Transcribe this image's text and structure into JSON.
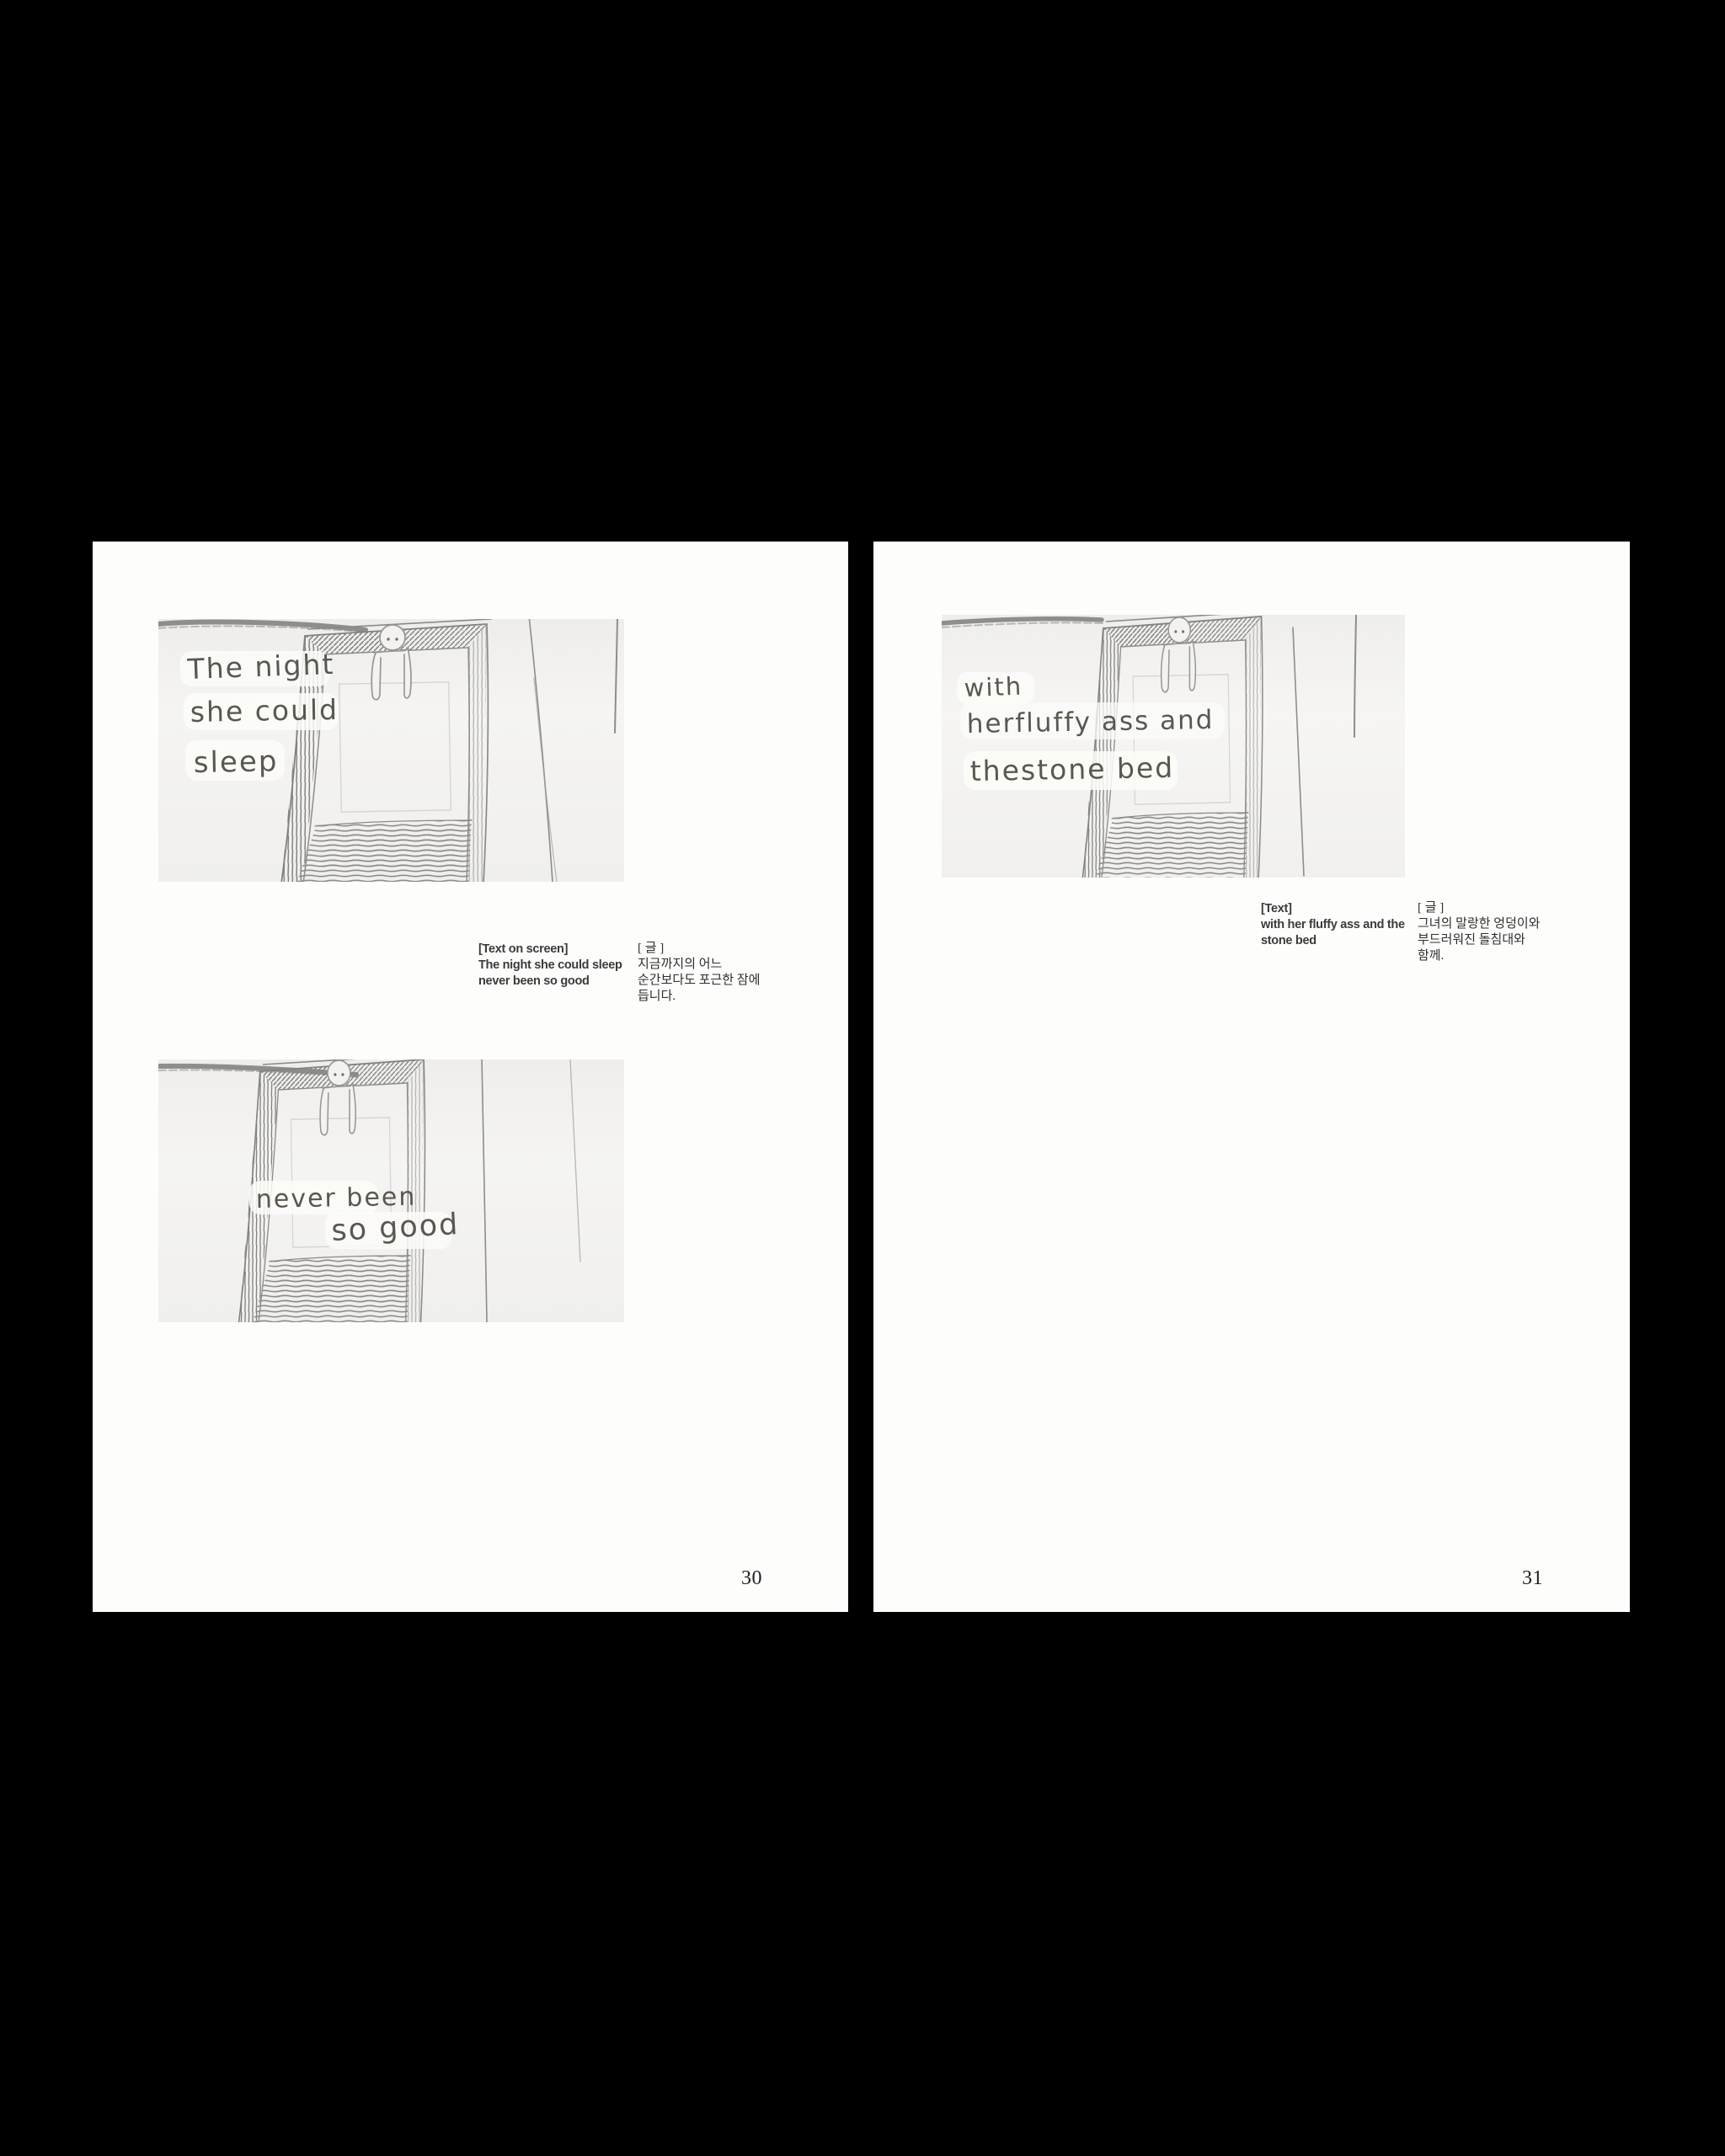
{
  "left_page": {
    "page_number": "30",
    "panels": [
      {
        "alt": "pencil sketch: figure draped over top of stone bed frame",
        "handwriting": [
          "The night",
          "she could",
          "sleep"
        ]
      },
      {
        "alt": "pencil sketch: same bed frame, text across middle",
        "handwriting": [
          "never been",
          "so good"
        ]
      }
    ],
    "caption": {
      "en_label": "[Text on screen]",
      "en_lines": [
        "The night she could sleep",
        "never been so good"
      ],
      "ko_label": "[ 글 ]",
      "ko_lines": [
        "지금까지의 어느",
        "순간보다도 포근한 잠에",
        "듭니다."
      ]
    }
  },
  "right_page": {
    "page_number": "31",
    "panels": [
      {
        "alt": "pencil sketch: bed frame with handwriting on left side",
        "handwriting": [
          "with",
          "herfluffy ass and",
          "thestone bed"
        ]
      }
    ],
    "caption": {
      "en_label": "[Text]",
      "en_lines": [
        "with her fluffy ass and the",
        "stone bed"
      ],
      "ko_label": "[ 글 ]",
      "ko_lines": [
        "그녀의 말랑한 엉덩이와",
        "부드러워진 돌침대와",
        "함께."
      ]
    }
  },
  "colors": {
    "background": "#000000",
    "paper": "#fdfdfc",
    "sketch_paper": "#f2f1ef",
    "pencil": "#8a8a87",
    "pencil_dark": "#75756f",
    "caption_text": "#3b3b3b",
    "page_number_text": "#1e1e1e",
    "handwriting": "#59584f"
  }
}
